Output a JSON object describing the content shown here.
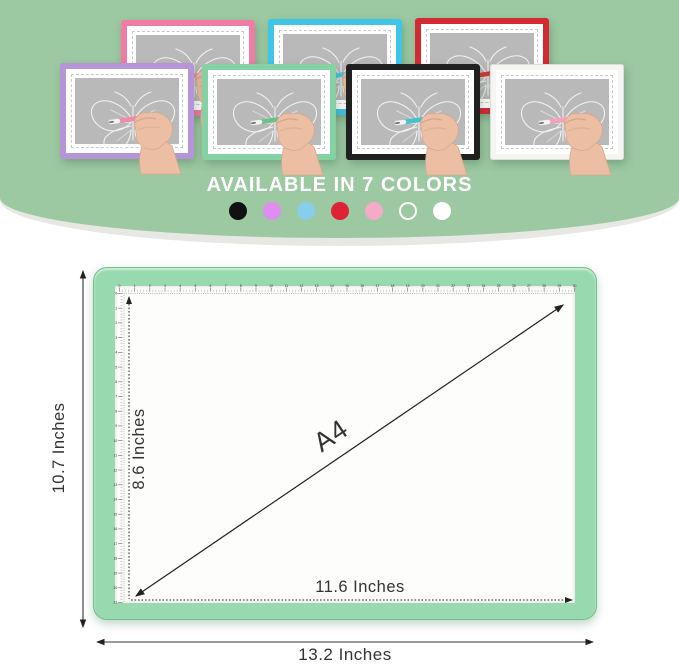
{
  "hero": {
    "title": "AVAILABLE IN 7 COLORS",
    "background_color": "#9cc9a2",
    "screen_color": "#b9b9b9",
    "tablets": [
      {
        "color_name": "pink",
        "frame_color": "#f27ba6",
        "pen_color": "#f08cb0",
        "x": 121,
        "y": 20,
        "row": "back"
      },
      {
        "color_name": "blue",
        "frame_color": "#3fc5e8",
        "pen_color": "#49c7e6",
        "x": 268,
        "y": 19,
        "row": "back"
      },
      {
        "color_name": "red",
        "frame_color": "#d42a33",
        "pen_color": "#d23b35",
        "x": 415,
        "y": 18,
        "row": "back"
      },
      {
        "color_name": "purple",
        "frame_color": "#b695d6",
        "pen_color": "#ef8aa8",
        "x": 60,
        "y": 63,
        "row": "front"
      },
      {
        "color_name": "green",
        "frame_color": "#85d1a4",
        "pen_color": "#6cc08a",
        "x": 202,
        "y": 64,
        "row": "front"
      },
      {
        "color_name": "black",
        "frame_color": "#202020",
        "pen_color": "#45c2cf",
        "x": 346,
        "y": 64,
        "row": "front"
      },
      {
        "color_name": "white",
        "frame_color": "#f5f6f3",
        "pen_color": "#f3a3bd",
        "x": 490,
        "y": 64,
        "row": "front"
      }
    ],
    "swatches": [
      {
        "name": "black",
        "fill": "#111111",
        "stroke": "none"
      },
      {
        "name": "purple",
        "fill": "#e08df2",
        "stroke": "none"
      },
      {
        "name": "light-blue",
        "fill": "#87ceea",
        "stroke": "none"
      },
      {
        "name": "red",
        "fill": "#dd2335",
        "stroke": "none"
      },
      {
        "name": "pink",
        "fill": "#f5abc8",
        "stroke": "none"
      },
      {
        "name": "white-outline",
        "fill": "none",
        "stroke": "#ffffff"
      },
      {
        "name": "white",
        "fill": "#ffffff",
        "stroke": "none"
      }
    ]
  },
  "diagram": {
    "pad_color": "#98d9af",
    "labels": {
      "outer_height": "10.7 Inches",
      "inner_height": "8.6 Inches",
      "diagonal": "A4",
      "inner_width": "11.6 Inches",
      "outer_width": "13.2 Inches"
    },
    "ruler": {
      "top": {
        "from": 0,
        "to": 30
      },
      "left": {
        "from": 0,
        "to": 21
      }
    }
  }
}
